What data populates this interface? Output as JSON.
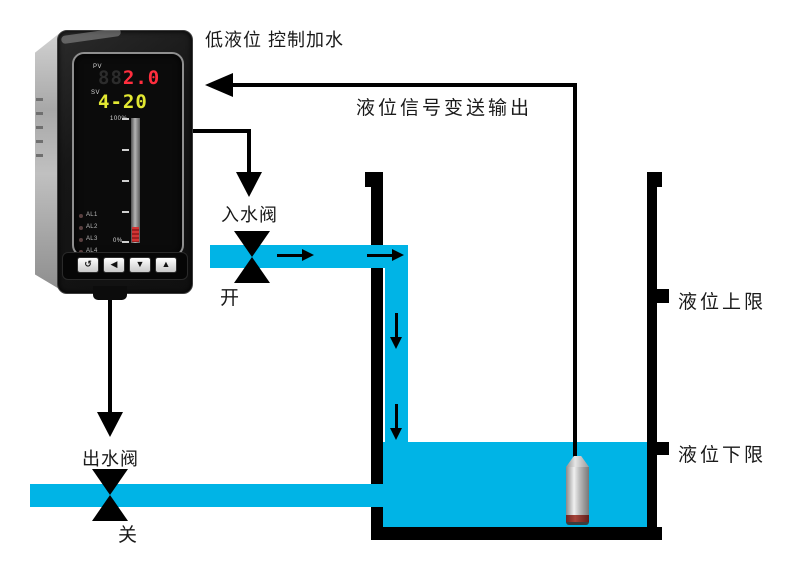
{
  "title": "低液位 控制加水",
  "signal": {
    "label": "液位信号变送输出"
  },
  "inlet_valve": {
    "name": "入水阀",
    "state": "开"
  },
  "outlet_valve": {
    "name": "出水阀",
    "state": "关"
  },
  "tank": {
    "upper_limit": "液位上限",
    "lower_limit": "液位下限"
  },
  "controller": {
    "pv_label": "PV",
    "pv_unlit": "88",
    "pv_value": "2.0",
    "sv_label": "SV",
    "sv_value": "4-20",
    "scale_max": "100%",
    "scale_min": "0%",
    "alarms": [
      "AL1",
      "AL2",
      "AL3",
      "AL4"
    ],
    "buttons": [
      "↺",
      "◀",
      "▼",
      "▲"
    ]
  },
  "colors": {
    "water": "#00b4e6",
    "pv_display": "#ff2e3e",
    "sv_display": "#e3e832",
    "bar_fill": "#c03030",
    "diagram_line": "#000000"
  }
}
